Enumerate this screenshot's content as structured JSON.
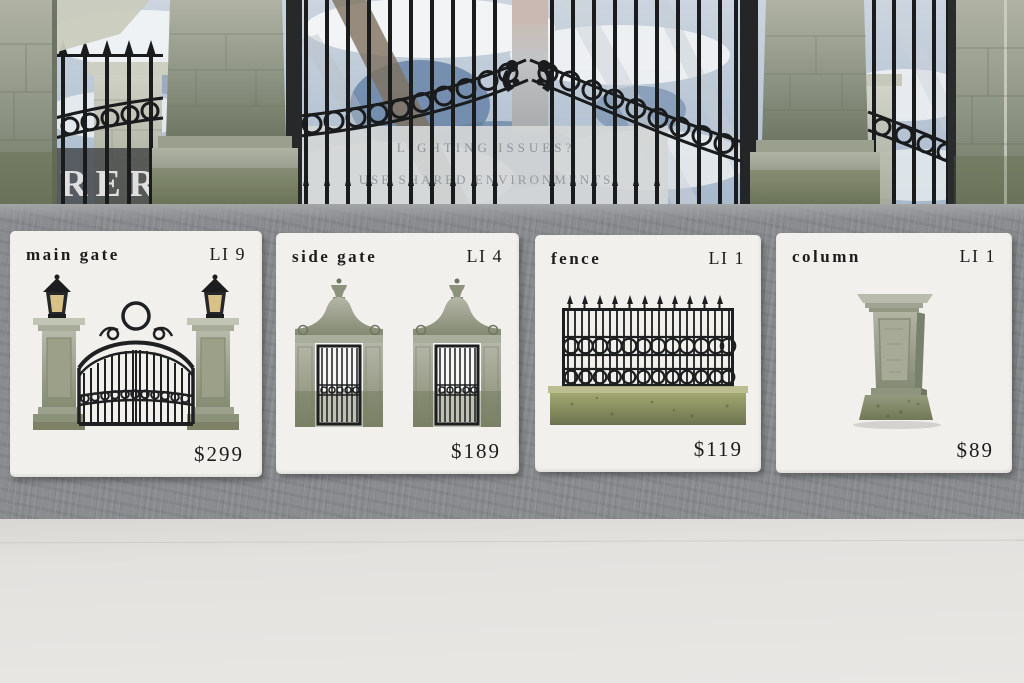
{
  "background_scene": {
    "sign_line1": "LIGHTING ISSUES?",
    "sign_line2": "USE SHARED ENVIRONMENTS",
    "partial_wall_text": "RER"
  },
  "products": [
    {
      "name": "main gate",
      "land_impact": "LI 9",
      "price": "$299",
      "image": "main-gate"
    },
    {
      "name": "side gate",
      "land_impact": "LI 4",
      "price": "$189",
      "image": "side-gate"
    },
    {
      "name": "fence",
      "land_impact": "LI 1",
      "price": "$119",
      "image": "fence"
    },
    {
      "name": "column",
      "land_impact": "LI 1",
      "price": "$89",
      "image": "column"
    }
  ],
  "theme": {
    "card_bg": "#f1f0ed",
    "card_text": "#1d1d1d",
    "wall": "#8a8c8f",
    "floor": "#e4e3e0",
    "iron": "#1a1b1d",
    "stone_light": "#c6c8ba",
    "stone_mid": "#9aa08c",
    "stone_moss": "#6d7456",
    "sky_blue": "#9fb2c8"
  }
}
